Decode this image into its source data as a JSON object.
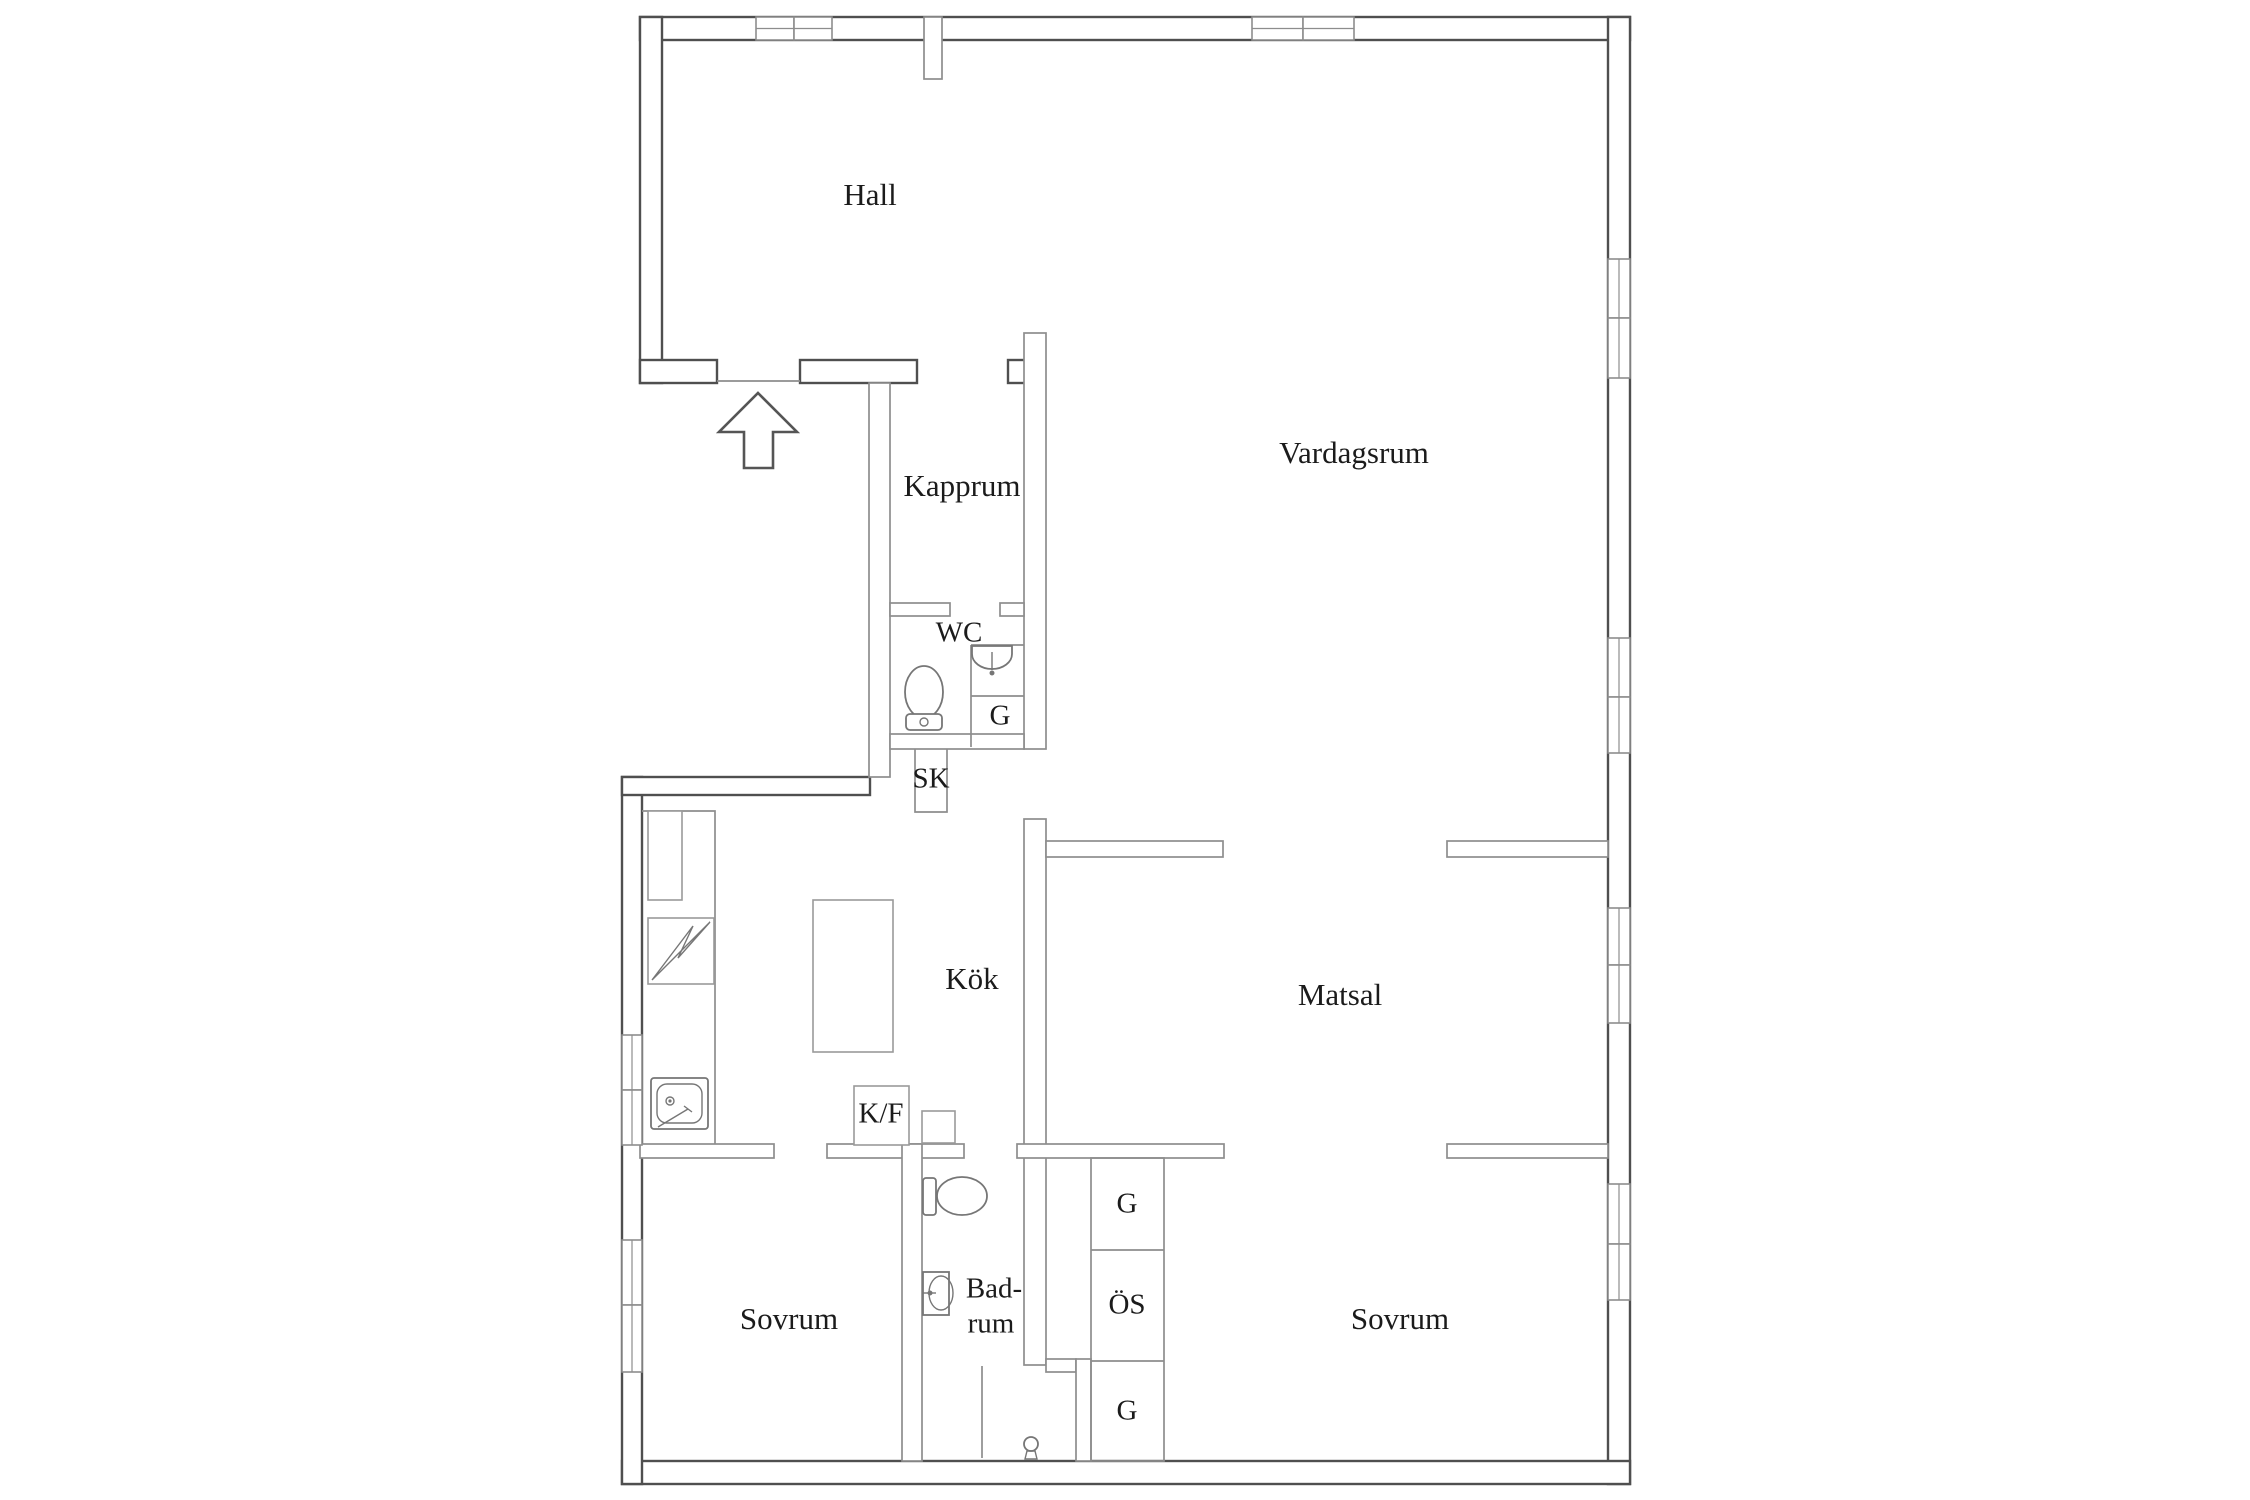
{
  "plan": {
    "type": "floor-plan",
    "rooms": [
      {
        "id": "hall",
        "label": "Hall"
      },
      {
        "id": "kapprum",
        "label": "Kapprum"
      },
      {
        "id": "wc",
        "label": "WC"
      },
      {
        "id": "wc-closet",
        "label": "G"
      },
      {
        "id": "sk-closet",
        "label": "SK"
      },
      {
        "id": "vardagsrum",
        "label": "Vardagsrum"
      },
      {
        "id": "kok",
        "label": "Kök"
      },
      {
        "id": "matsal",
        "label": "Matsal"
      },
      {
        "id": "kyl-frys",
        "label": "K/F"
      },
      {
        "id": "sovrum-vanster",
        "label": "Sovrum"
      },
      {
        "id": "badrum-line1",
        "label": "Bad-"
      },
      {
        "id": "badrum-line2",
        "label": "rum"
      },
      {
        "id": "sovrum-hoger",
        "label": "Sovrum"
      },
      {
        "id": "closet-g-top",
        "label": "G"
      },
      {
        "id": "closet-os",
        "label": "ÖS"
      },
      {
        "id": "closet-g-bottom",
        "label": "G"
      }
    ],
    "icons": [
      "entrance-arrow-icon",
      "toilet-icon",
      "washbasin-icon",
      "shower-head-icon",
      "kitchen-sink-icon",
      "stove-icon",
      "kitchen-island",
      "tall-cabinet",
      "fridge-freezer-box"
    ],
    "colors": {
      "background": "#ffffff",
      "outer_wall": "#4f4f4f",
      "inner_wall": "#8d8d8d",
      "fixture": "#767676",
      "text": "#1b1b1b"
    }
  }
}
